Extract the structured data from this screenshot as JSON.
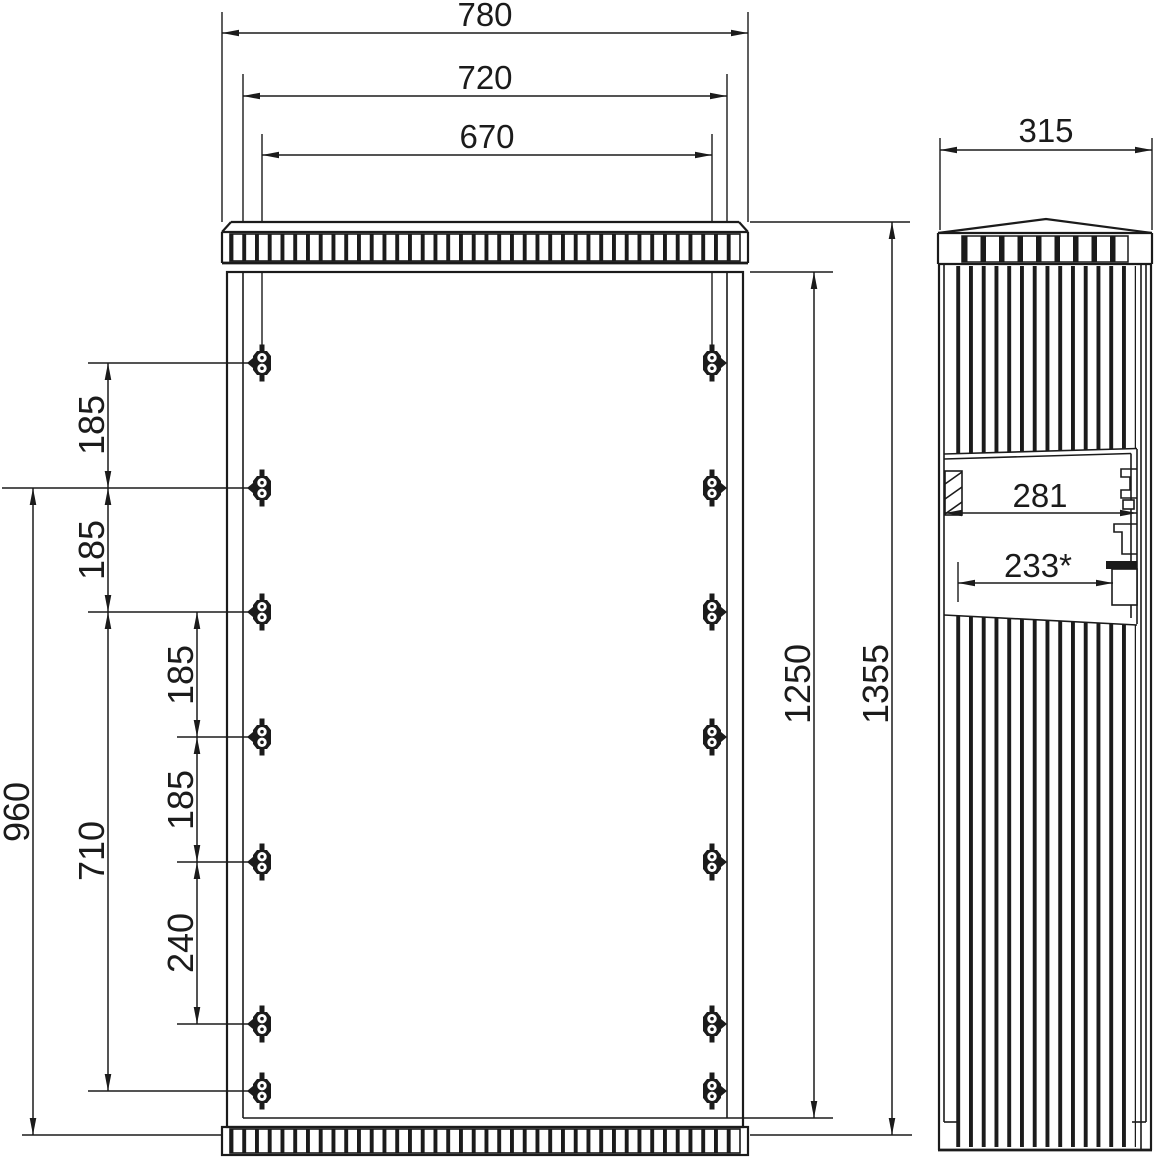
{
  "drawing_type": "enclosure-dimensional-drawing",
  "colors": {
    "ink": "#1b1b1b",
    "background": "#ffffff"
  },
  "dimensions": {
    "dim_780": "780",
    "dim_720": "720",
    "dim_670": "670",
    "dim_185_1": "185",
    "dim_185_2": "185",
    "dim_185_3": "185",
    "dim_185_4": "185",
    "dim_240": "240",
    "dim_710": "710",
    "dim_960": "960",
    "dim_1250": "1250",
    "dim_1355": "1355",
    "dim_315": "315",
    "dim_281": "281",
    "dim_233": "233*"
  }
}
